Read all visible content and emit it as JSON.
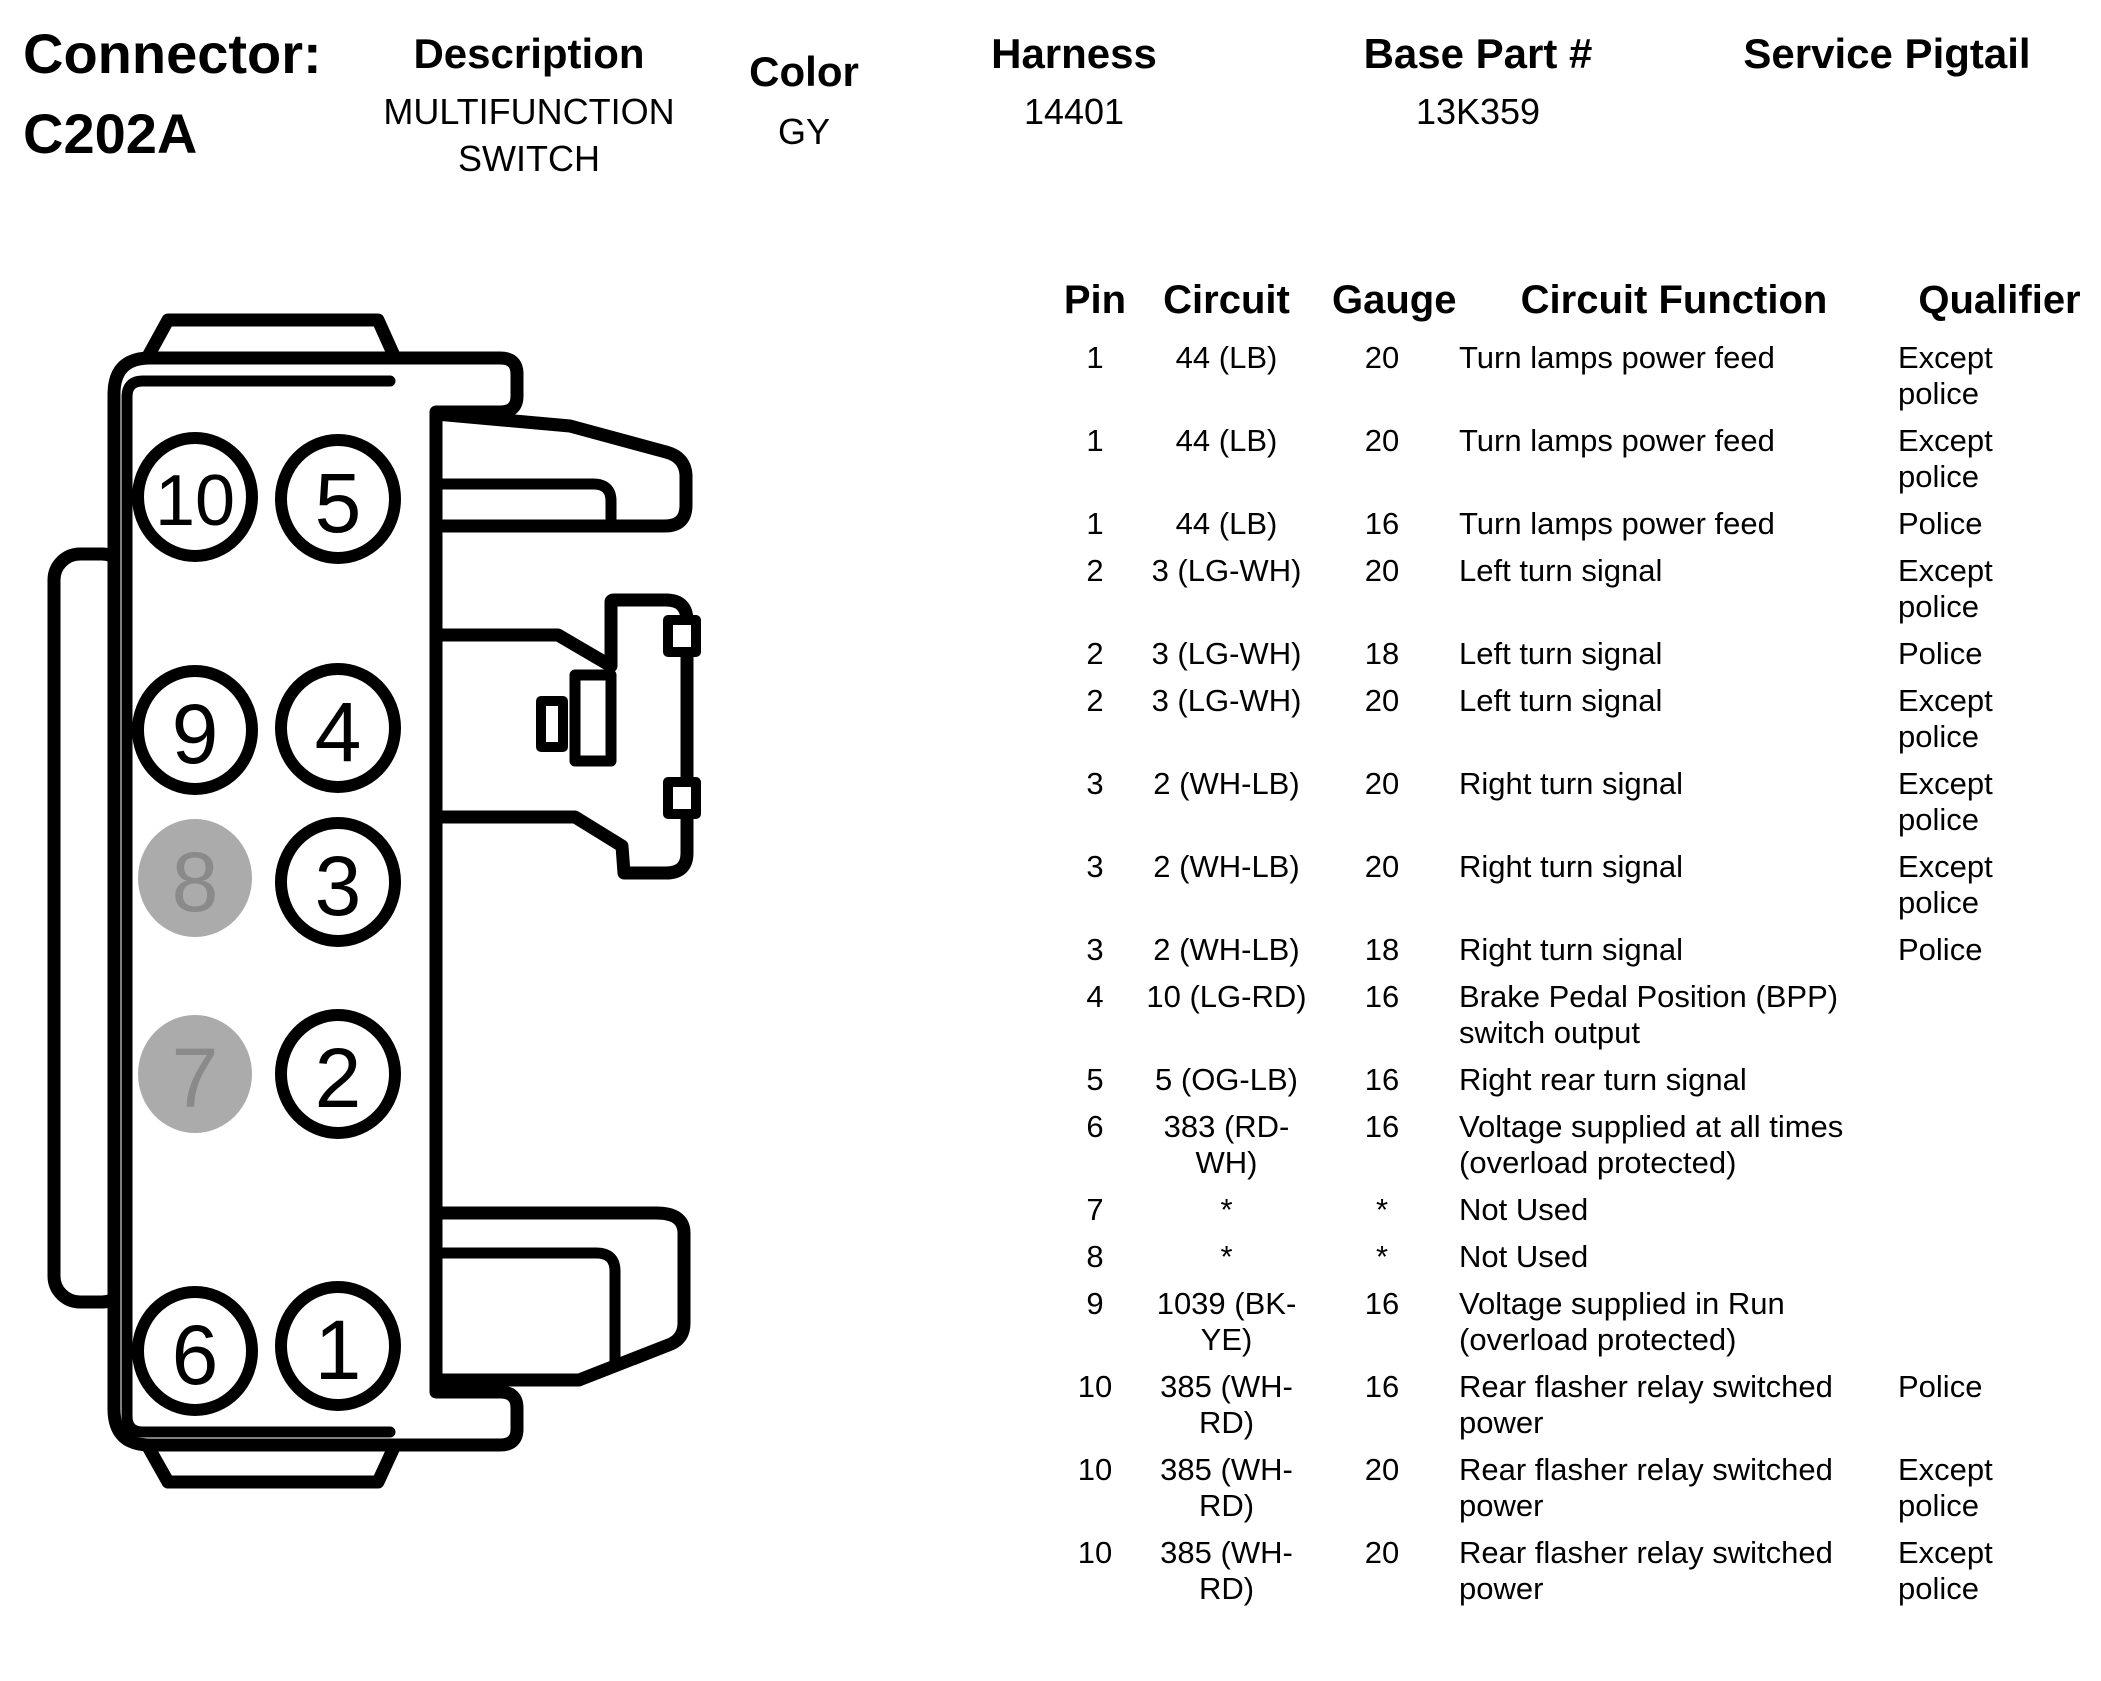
{
  "page": {
    "background": "#FFFFFF",
    "text_color": "#000000"
  },
  "header": {
    "connector_label": "Connector:",
    "connector_id": "C202A",
    "fields": [
      {
        "label": "Description",
        "values": [
          "MULTIFUNCTION",
          "SWITCH"
        ]
      },
      {
        "label": "Color",
        "values": [
          "GY"
        ]
      },
      {
        "label": "Harness",
        "values": [
          "14401"
        ]
      },
      {
        "label": "Base Part #",
        "values": [
          "13K359"
        ]
      },
      {
        "label": "Service Pigtail",
        "values": []
      }
    ]
  },
  "connector_diagram": {
    "pins": [
      {
        "number": "10",
        "filled": false
      },
      {
        "number": "5",
        "filled": false
      },
      {
        "number": "9",
        "filled": false
      },
      {
        "number": "4",
        "filled": false
      },
      {
        "number": "8",
        "filled": true
      },
      {
        "number": "3",
        "filled": false
      },
      {
        "number": "7",
        "filled": true
      },
      {
        "number": "2",
        "filled": false
      },
      {
        "number": "6",
        "filled": false
      },
      {
        "number": "1",
        "filled": false
      }
    ],
    "outline_color": "#000000",
    "filled_pin_color": "#ABABAB",
    "filled_pin_number_color": "#8A8A8A"
  },
  "pin_table": {
    "columns": [
      "Pin",
      "Circuit",
      "Gauge",
      "Circuit Function",
      "Qualifier"
    ],
    "rows": [
      {
        "pin": "1",
        "circuit": [
          "44 (LB)"
        ],
        "gauge": "20",
        "function": [
          "Turn lamps power feed"
        ],
        "qualifier": [
          "Except",
          "police"
        ]
      },
      {
        "pin": "1",
        "circuit": [
          "44 (LB)"
        ],
        "gauge": "20",
        "function": [
          "Turn lamps power feed"
        ],
        "qualifier": [
          "Except",
          "police"
        ]
      },
      {
        "pin": "1",
        "circuit": [
          "44 (LB)"
        ],
        "gauge": "16",
        "function": [
          "Turn lamps power feed"
        ],
        "qualifier": [
          "Police"
        ]
      },
      {
        "pin": "2",
        "circuit": [
          "3 (LG-WH)"
        ],
        "gauge": "20",
        "function": [
          "Left turn signal"
        ],
        "qualifier": [
          "Except",
          "police"
        ]
      },
      {
        "pin": "2",
        "circuit": [
          "3 (LG-WH)"
        ],
        "gauge": "18",
        "function": [
          "Left turn signal"
        ],
        "qualifier": [
          "Police"
        ]
      },
      {
        "pin": "2",
        "circuit": [
          "3 (LG-WH)"
        ],
        "gauge": "20",
        "function": [
          "Left turn signal"
        ],
        "qualifier": [
          "Except",
          "police"
        ]
      },
      {
        "pin": "3",
        "circuit": [
          "2 (WH-LB)"
        ],
        "gauge": "20",
        "function": [
          "Right turn signal"
        ],
        "qualifier": [
          "Except",
          "police"
        ]
      },
      {
        "pin": "3",
        "circuit": [
          "2 (WH-LB)"
        ],
        "gauge": "20",
        "function": [
          "Right turn signal"
        ],
        "qualifier": [
          "Except",
          "police"
        ]
      },
      {
        "pin": "3",
        "circuit": [
          "2 (WH-LB)"
        ],
        "gauge": "18",
        "function": [
          "Right turn signal"
        ],
        "qualifier": [
          "Police"
        ]
      },
      {
        "pin": "4",
        "circuit": [
          "10 (LG-RD)"
        ],
        "gauge": "16",
        "function": [
          "Brake Pedal Position (BPP)",
          "switch output"
        ],
        "qualifier": []
      },
      {
        "pin": "5",
        "circuit": [
          "5 (OG-LB)"
        ],
        "gauge": "16",
        "function": [
          "Right rear turn signal"
        ],
        "qualifier": []
      },
      {
        "pin": "6",
        "circuit": [
          "383 (RD-",
          "WH)"
        ],
        "gauge": "16",
        "function": [
          "Voltage supplied at all times",
          "(overload protected)"
        ],
        "qualifier": []
      },
      {
        "pin": "7",
        "circuit": [
          "*"
        ],
        "gauge": "*",
        "function": [
          "Not Used"
        ],
        "qualifier": []
      },
      {
        "pin": "8",
        "circuit": [
          "*"
        ],
        "gauge": "*",
        "function": [
          "Not Used"
        ],
        "qualifier": []
      },
      {
        "pin": "9",
        "circuit": [
          "1039 (BK-",
          "YE)"
        ],
        "gauge": "16",
        "function": [
          "Voltage supplied in Run",
          "(overload protected)"
        ],
        "qualifier": []
      },
      {
        "pin": "10",
        "circuit": [
          "385 (WH-",
          "RD)"
        ],
        "gauge": "16",
        "function": [
          "Rear flasher relay switched",
          "power"
        ],
        "qualifier": [
          "Police"
        ]
      },
      {
        "pin": "10",
        "circuit": [
          "385 (WH-",
          "RD)"
        ],
        "gauge": "20",
        "function": [
          "Rear flasher relay switched",
          "power"
        ],
        "qualifier": [
          "Except",
          "police"
        ]
      },
      {
        "pin": "10",
        "circuit": [
          "385 (WH-",
          "RD)"
        ],
        "gauge": "20",
        "function": [
          "Rear flasher relay switched",
          "power"
        ],
        "qualifier": [
          "Except",
          "police"
        ]
      }
    ]
  }
}
